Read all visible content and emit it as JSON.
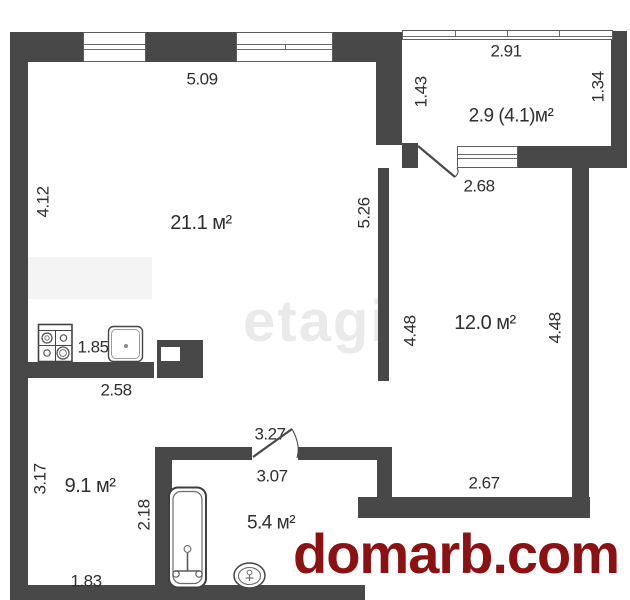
{
  "title": "apartment-floor-plan",
  "rooms": {
    "living": "21.1 м²",
    "balcony": "2.9 (4.1)м²",
    "bedroom": "12.0 м²",
    "room9": "9.1 м²",
    "bath": "5.4 м²"
  },
  "dims": {
    "living_top": "5.09",
    "living_left": "4.12",
    "balcony_width": "2.91",
    "balcony_left": "1.43",
    "balcony_right": "1.34",
    "balcony_door_width": "2.68",
    "hall_height": "5.26",
    "bedroom_left_height": "4.48",
    "bedroom_right_height": "4.48",
    "bedroom_width": "2.67",
    "kitchen_gap": "1.85",
    "counter_width": "2.58",
    "room9_height": "3.17",
    "room9_width": "1.83",
    "bath_door_width": "3.27",
    "bath_width": "3.07",
    "bath_left_height": "2.18",
    "tub_length": "1.88"
  },
  "watermarks": {
    "agency": "etagi",
    "site": "domarb.com"
  },
  "icons": [
    "stove-icon",
    "sink-icon",
    "bathtub-icon",
    "toilet-icon",
    "door-swing-icon"
  ],
  "colors": {
    "wall": "#484848",
    "dim_text": "#2f2f2f",
    "site_watermark": "#8b1113",
    "agency_watermark": "#eaeaea"
  }
}
